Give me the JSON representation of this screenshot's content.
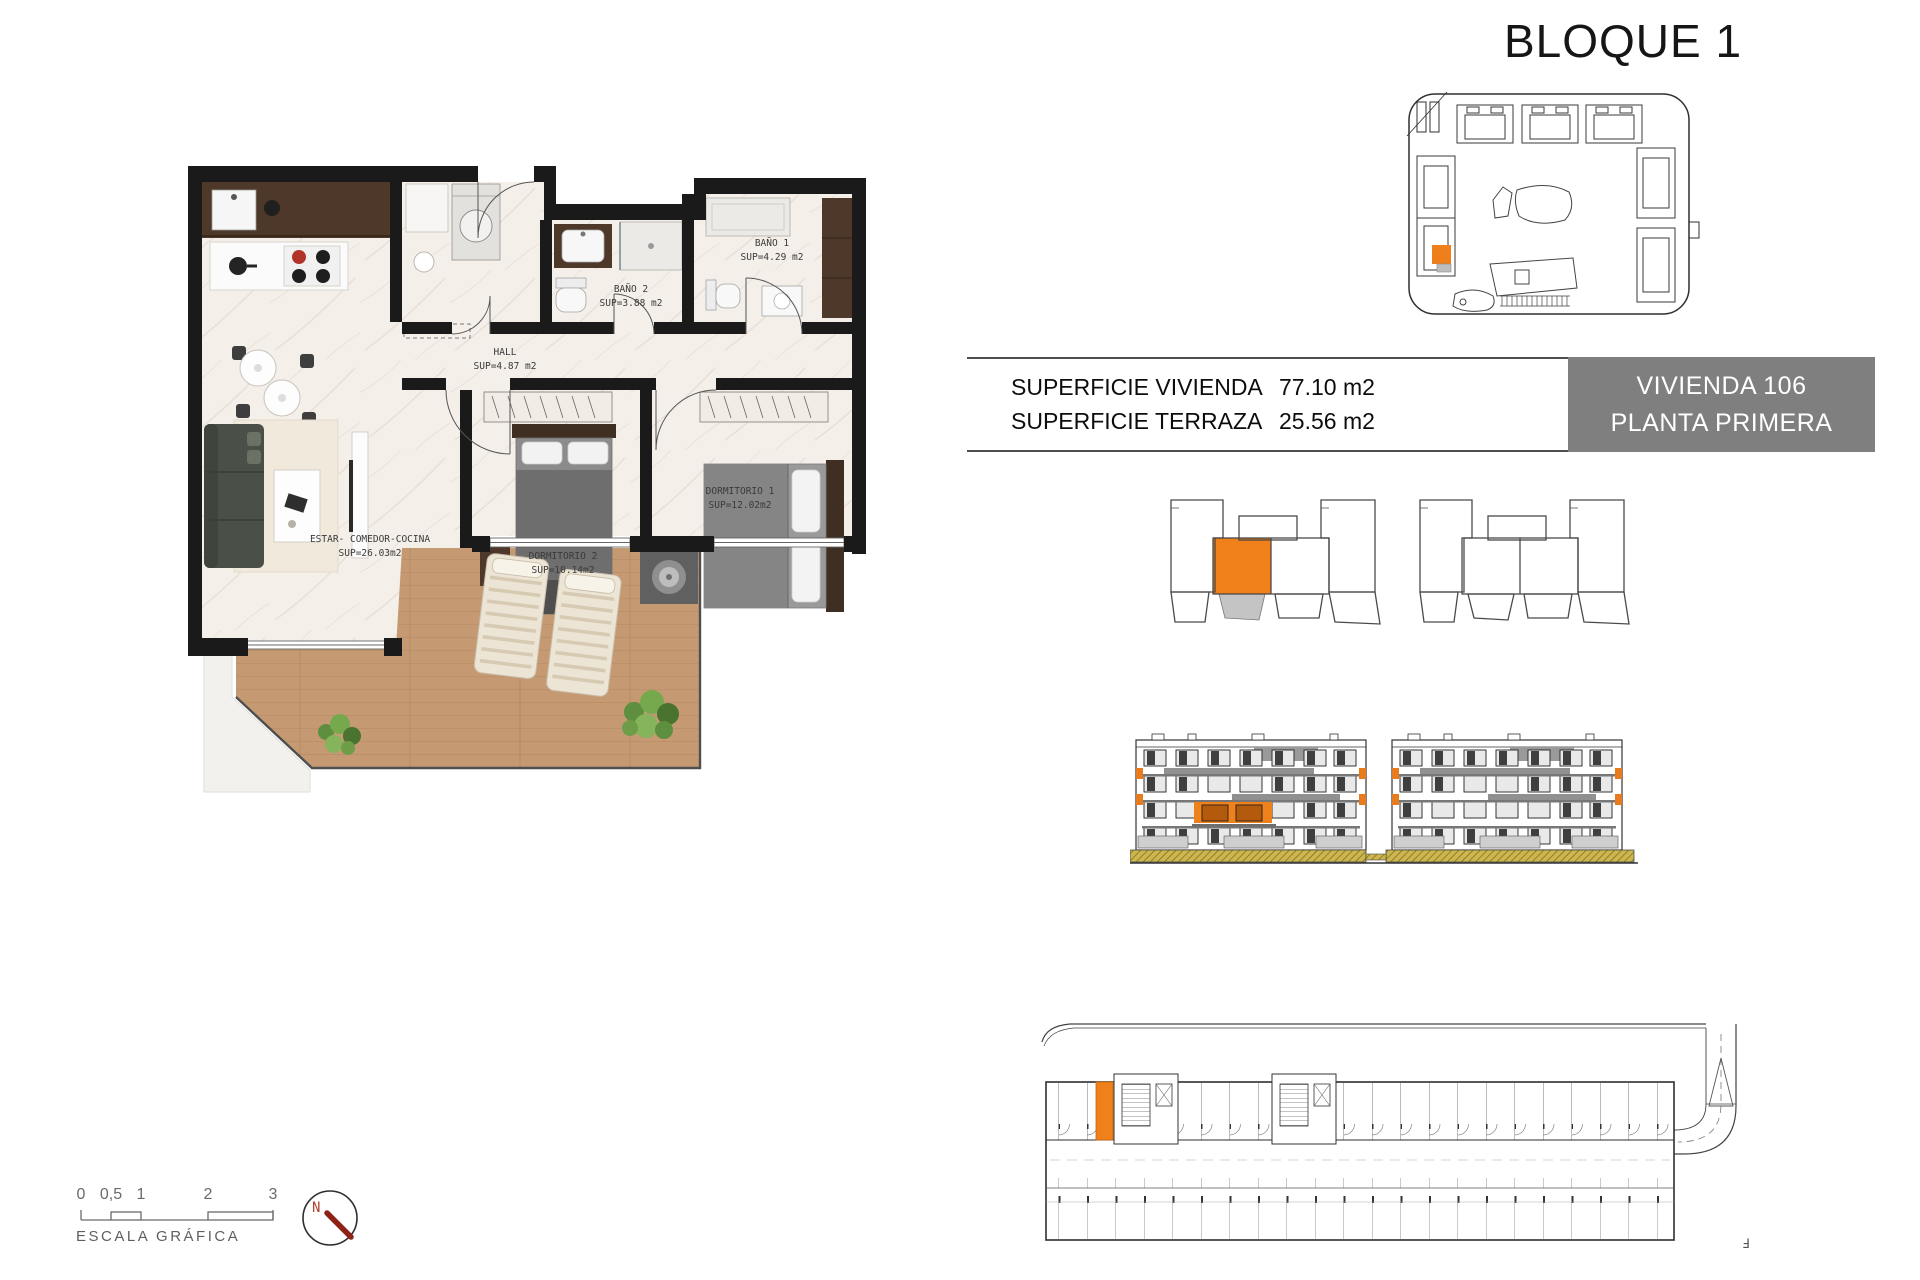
{
  "title": "BLOQUE 1",
  "info_table": {
    "rows": [
      {
        "label": "SUPERFICIE VIVIENDA",
        "value": "77.10 m2"
      },
      {
        "label": "SUPERFICIE TERRAZA",
        "value": "25.56 m2"
      }
    ]
  },
  "unit_box": {
    "line1": "VIVIENDA 106",
    "line2": "PLANTA PRIMERA"
  },
  "floor_plan": {
    "rooms": [
      {
        "name": "BAÑO 1",
        "area": "SUP=4.29 m2"
      },
      {
        "name": "BAÑO 2",
        "area": "SUP=3.88 m2"
      },
      {
        "name": "HALL",
        "area": "SUP=4.87 m2"
      },
      {
        "name": "DORMITORIO 1",
        "area": "SUP=12.02m2"
      },
      {
        "name": "DORMITORIO 2",
        "area": "SUP=10.14m2"
      },
      {
        "name": "ESTAR- COMEDOR-COCINA",
        "area": "SUP=26.03m2"
      }
    ]
  },
  "scale_bar": {
    "ticks": [
      "0",
      "0,5",
      "1",
      "2",
      "3"
    ],
    "label": "ESCALA GRÁFICA"
  },
  "compass": {
    "north": "N"
  },
  "sheet_mark": "Ⅎ",
  "colors": {
    "accent_orange": "#F08019",
    "unit_box_gray": "#7F7F7F",
    "terrace_gray": "#C4C4C4",
    "ground_olive": "#CDB64E"
  }
}
